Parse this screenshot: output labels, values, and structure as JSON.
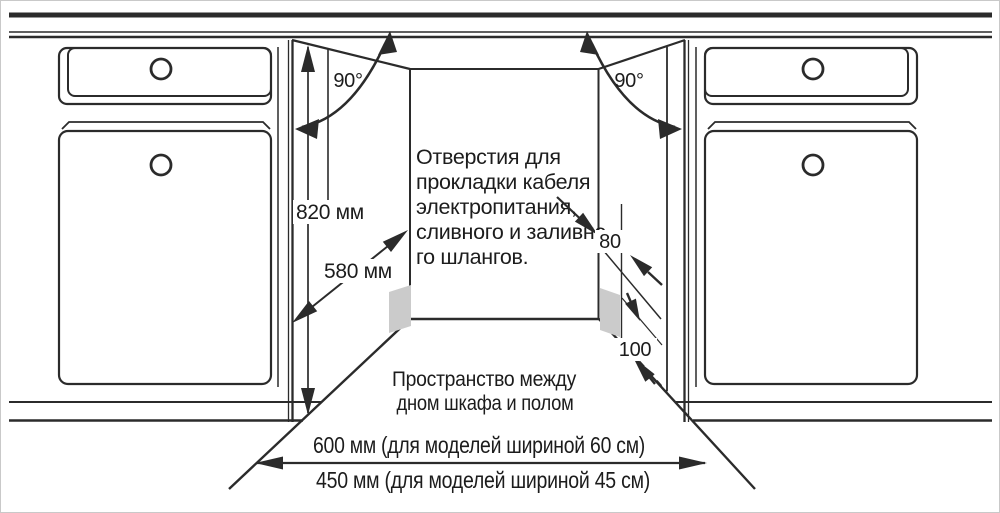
{
  "diagram": {
    "colors": {
      "line": "#2b2b2b",
      "text": "#1c1c1c",
      "hole_fill": "#cbcbcb",
      "background": "#ffffff"
    },
    "labels": {
      "angle_left": "90°",
      "angle_right": "90°",
      "niche_height": "820 мм",
      "niche_depth": "580 мм",
      "hole_dim_top": "80",
      "hole_dim_bottom": "100",
      "holes_note_lines": [
        "Отверстия для",
        "прокладки кабеля",
        "электропитания,",
        "сливного и заливно",
        "го шлангов."
      ],
      "floor_note_lines": [
        "Пространство между",
        "дном шкафа и полом"
      ],
      "width_600": "600 мм (для моделей шириной 60 см)",
      "width_450": "450 мм (для моделей шириной 45 см)"
    }
  }
}
